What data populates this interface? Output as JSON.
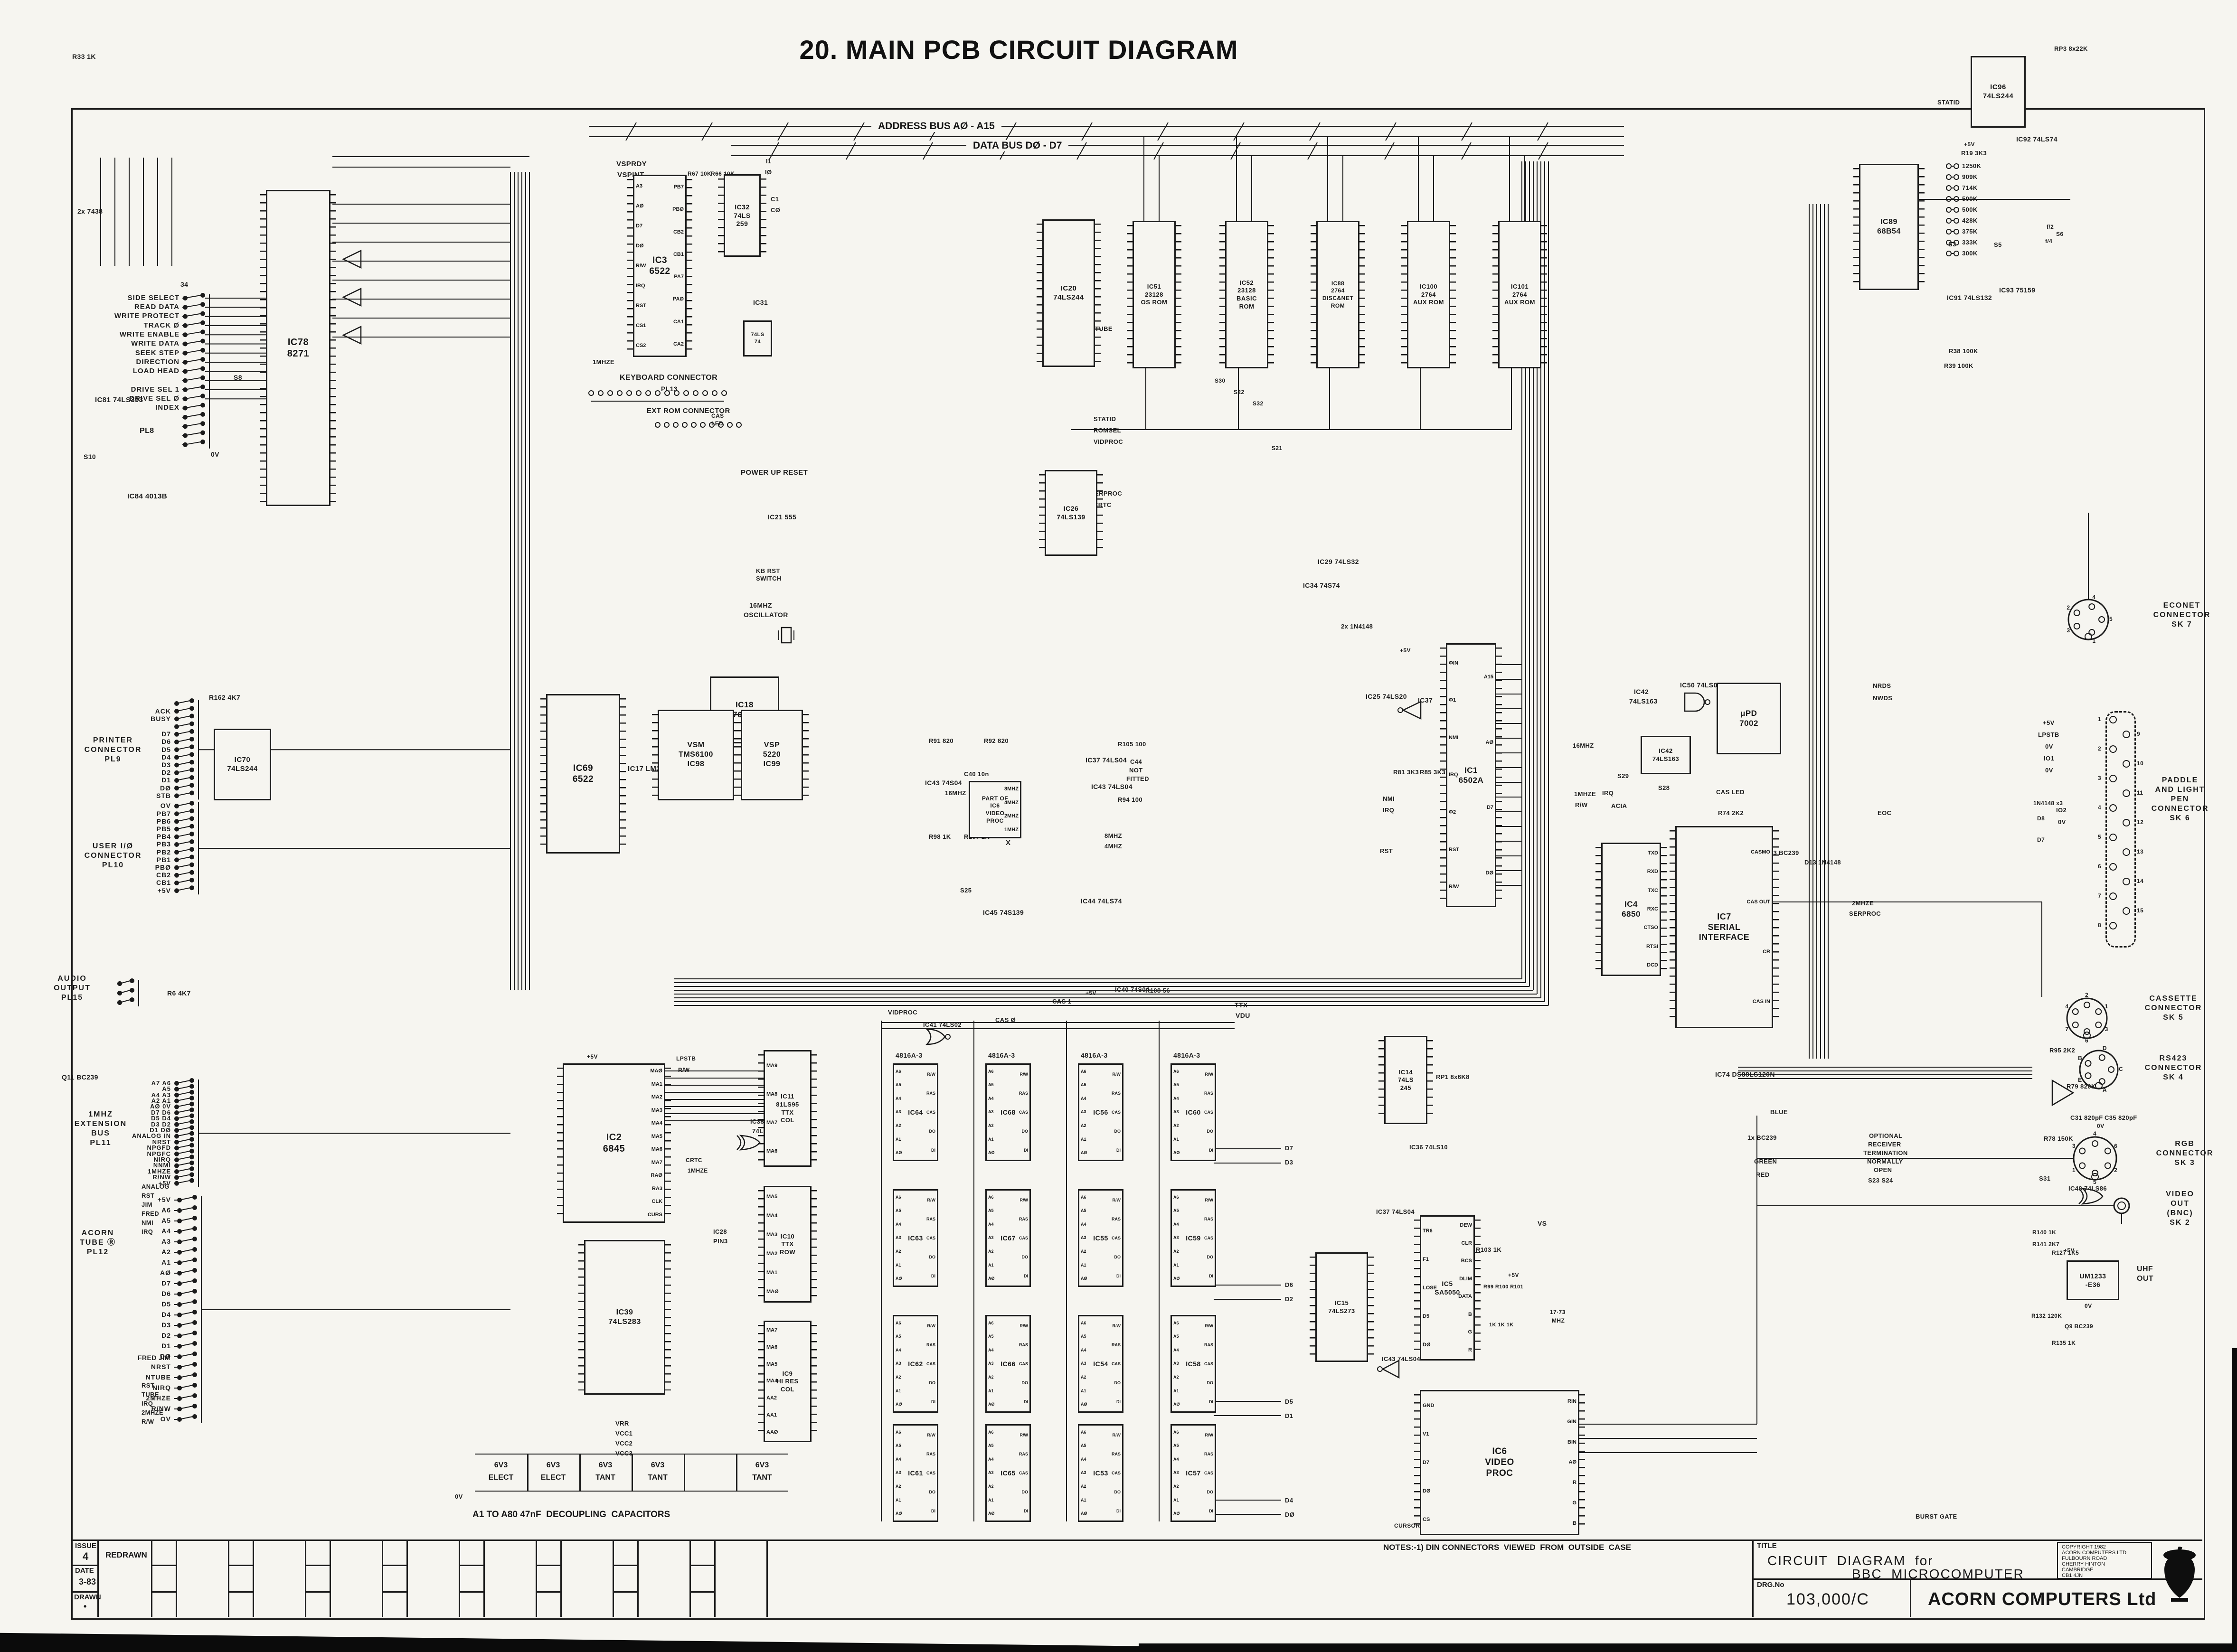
{
  "page": {
    "title": "20. MAIN PCB CIRCUIT DIAGRAM"
  },
  "buses": {
    "address": "ADDRESS BUS AØ - A15",
    "data": "DATA BUS DØ - D7"
  },
  "notes": {
    "note1": "NOTES:-1) DIN CONNECTORS  VIEWED  FROM  OUTSIDE  CASE",
    "decoupling": "A1 TO A80 47nF  DECOUPLING  CAPACITORS"
  },
  "revision": {
    "issue_label": "ISSUE",
    "issue_value": "4",
    "date_label": "DATE",
    "date_value": "3-83",
    "drawn_label": "DRAWN",
    "drawn_value": "•",
    "change_label": "REDRAWN"
  },
  "title_block": {
    "title_label": "TITLE",
    "title_line1": "CIRCUIT  DIAGRAM  for",
    "title_line2": "BBC  MICROCOMPUTER",
    "drg_label": "DRG.No",
    "drg_no": "103,000/C",
    "company": "ACORN COMPUTERS Ltd",
    "copyright_lines": [
      "COPYRIGHT 1982",
      "ACORN COMPUTERS LTD",
      "FULBOURN ROAD",
      "CHERRY HINTON",
      "CAMBRIDGE",
      "CB1 4JN"
    ]
  },
  "caps_table": [
    [
      "6V3",
      "ELECT"
    ],
    [
      "6V3",
      "ELECT"
    ],
    [
      "6V3",
      "TANT"
    ],
    [
      "6V3",
      "TANT"
    ],
    [
      "",
      ""
    ],
    [
      "6V3",
      "TANT"
    ]
  ],
  "ram": {
    "part": "4816A-3",
    "grid": [
      [
        "IC64",
        "IC68",
        "IC56",
        "IC60"
      ],
      [
        "IC63",
        "IC67",
        "IC55",
        "IC59"
      ],
      [
        "IC62",
        "IC66",
        "IC54",
        "IC58"
      ],
      [
        "IC61",
        "IC65",
        "IC53",
        "IC57"
      ]
    ],
    "left_pins": [
      "A6",
      "A5",
      "A4",
      "A3",
      "A2",
      "A1",
      "AØ"
    ],
    "right_pins": [
      "R/W",
      "RAS",
      "CAS",
      "DO",
      "DI"
    ]
  },
  "econet_links": [
    "1250K",
    "909K",
    "714K",
    "500K",
    "500K",
    "428K",
    "375K",
    "333K",
    "300K"
  ],
  "ics": [
    {
      "id": "IC78",
      "lines": [
        "IC78",
        "8271"
      ]
    },
    {
      "id": "IC3",
      "lines": [
        "IC3",
        "6522"
      ],
      "left": [
        "A3",
        "AØ",
        "D7",
        "DØ",
        "R/W",
        "IRQ",
        "RST",
        "CS1",
        "CS2"
      ],
      "right": [
        "PB7",
        "PBØ",
        "CB2",
        "CB1",
        "PA7",
        "PAØ",
        "CA1",
        "CA2"
      ]
    },
    {
      "id": "IC32",
      "lines": [
        "IC32",
        "74LS",
        "259"
      ]
    },
    {
      "id": "IC31",
      "lines": [
        "74LS",
        "74"
      ]
    },
    {
      "id": "IC20",
      "lines": [
        "IC20",
        "74LS244"
      ]
    },
    {
      "id": "IC51",
      "lines": [
        "IC51",
        "23128",
        "OS ROM"
      ]
    },
    {
      "id": "IC52",
      "lines": [
        "IC52",
        "23128",
        "BASIC",
        "ROM"
      ]
    },
    {
      "id": "IC88",
      "lines": [
        "IC88",
        "2764",
        "DISC&NET",
        "ROM"
      ]
    },
    {
      "id": "IC100",
      "lines": [
        "IC100",
        "2764",
        "AUX ROM"
      ]
    },
    {
      "id": "IC101",
      "lines": [
        "IC101",
        "2764",
        "AUX ROM"
      ]
    },
    {
      "id": "IC96",
      "lines": [
        "IC96",
        "74LS244"
      ]
    },
    {
      "id": "IC89",
      "lines": [
        "IC89",
        "68B54"
      ]
    },
    {
      "id": "IC26",
      "lines": [
        "IC26",
        "74LS139"
      ]
    },
    {
      "id": "IC18",
      "lines": [
        "IC18",
        "76489"
      ]
    },
    {
      "id": "IC98",
      "lines": [
        "VSM",
        "TMS6100",
        "IC98"
      ]
    },
    {
      "id": "IC99",
      "lines": [
        "VSP",
        "5220",
        "IC99"
      ]
    },
    {
      "id": "IC69",
      "lines": [
        "IC69",
        "6522"
      ]
    },
    {
      "id": "IC70",
      "lines": [
        "IC70",
        "74LS244"
      ]
    },
    {
      "id": "IC1",
      "lines": [
        "IC1",
        "6502A"
      ],
      "left": [
        "ΦIN",
        "Φ1",
        "NMI",
        "IRQ",
        "Φ2",
        "RST",
        "R/W"
      ],
      "right": [
        "A15",
        "AØ",
        "D7",
        "DØ"
      ]
    },
    {
      "id": "IC42",
      "lines": [
        "IC42",
        "74LS163"
      ]
    },
    {
      "id": "IC4",
      "lines": [
        "IC4",
        "6850"
      ],
      "right": [
        "TXD",
        "RXD",
        "TXC",
        "RXC",
        "CTSO",
        "RTSI",
        "DCD"
      ]
    },
    {
      "id": "IC7",
      "lines": [
        "IC7",
        "SERIAL",
        "INTERFACE"
      ],
      "right": [
        "CASMO",
        "CAS OUT",
        "CR",
        "CAS IN"
      ]
    },
    {
      "id": "IC73",
      "lines": [
        "µPD",
        "7002"
      ]
    },
    {
      "id": "IC2",
      "lines": [
        "IC2",
        "6845"
      ],
      "right": [
        "MAØ",
        "MA1",
        "MA2",
        "MA3",
        "MA4",
        "MA5",
        "MA6",
        "MA7",
        "RAØ",
        "RA3",
        "CLK",
        "CURS"
      ]
    },
    {
      "id": "IC11",
      "lines": [
        "IC11",
        "81LS95",
        "TTX",
        "COL"
      ],
      "left": [
        "MA9",
        "MA8",
        "MA7",
        "MA6"
      ]
    },
    {
      "id": "IC10",
      "lines": [
        "IC10",
        "TTX",
        "ROW"
      ],
      "left": [
        "MA5",
        "MA4",
        "MA3",
        "MA2",
        "MA1",
        "MAØ"
      ]
    },
    {
      "id": "IC9",
      "lines": [
        "IC9",
        "HI RES",
        "COL"
      ],
      "left": [
        "MA7",
        "MA6",
        "MA5",
        "MA4",
        "AA2",
        "AA1",
        "AAØ"
      ]
    },
    {
      "id": "IC39",
      "lines": [
        "IC39",
        "74LS283"
      ]
    },
    {
      "id": "IC14",
      "lines": [
        "IC14",
        "74LS",
        "245"
      ]
    },
    {
      "id": "IC15",
      "lines": [
        "IC15",
        "74LS273"
      ]
    },
    {
      "id": "IC5",
      "lines": [
        "IC5",
        "SA5050"
      ],
      "left": [
        "TR6",
        "F1",
        "LOSE",
        "D5",
        "DØ"
      ],
      "right": [
        "DEW",
        "CLR",
        "BCS",
        "DLIM",
        "DATA",
        "B",
        "G",
        "R"
      ]
    },
    {
      "id": "IC6",
      "lines": [
        "IC6",
        "VIDEO",
        "PROC"
      ],
      "left": [
        "GND",
        "V1",
        "D7",
        "DØ",
        "CS"
      ],
      "right": [
        "RIN",
        "GIN",
        "BIN",
        "AØ",
        "R",
        "G",
        "B"
      ]
    },
    {
      "id": "UM1233",
      "lines": [
        "UM1233",
        "-E36"
      ]
    },
    {
      "id": "IC6CLK",
      "lines": [
        "PART OF",
        "IC6",
        "VIDEO",
        "PROC"
      ],
      "right": [
        "8MHZ",
        "4MHZ",
        "2MHZ",
        "1MHZ"
      ]
    }
  ],
  "left_conns": [
    {
      "heading": [],
      "pins": [
        "SIDE SELECT",
        "READ DATA",
        "WRITE PROTECT",
        "TRACK Ø",
        "WRITE ENABLE",
        "WRITE DATA",
        "SEEK STEP",
        "DIRECTION",
        "LOAD HEAD",
        "",
        "DRIVE SEL 1",
        "DRIVE SEL Ø",
        "INDEX",
        "",
        "",
        "",
        ""
      ]
    },
    {
      "heading": [
        "PRINTER",
        "CONNECTOR",
        "PL9"
      ],
      "pins": [
        "",
        "ACK",
        "BUSY",
        "",
        "D7",
        "D6",
        "D5",
        "D4",
        "D3",
        "D2",
        "D1",
        "DØ",
        "STB"
      ]
    },
    {
      "heading": [
        "USER I/Ø",
        "CONNECTOR",
        "PL10"
      ],
      "pins": [
        "OV",
        "PB7",
        "PB6",
        "PB5",
        "PB4",
        "PB3",
        "PB2",
        "PB1",
        "PBØ",
        "CB2",
        "CB1",
        "+5V"
      ]
    },
    {
      "heading": [
        "1MHZ",
        "EXTENSION",
        "BUS",
        "PL11"
      ],
      "pins": [
        "A7 A6",
        "A5",
        "A4 A3",
        "A2 A1",
        "AØ 0V",
        "D7 D6",
        "D5 D4",
        "D3 D2",
        "D1 DØ",
        "ANALOG IN",
        "NRST",
        "NPGFD",
        "NPGFC",
        "NIRQ",
        "NNMI",
        "1MHZE",
        "R/NW",
        "+5V"
      ]
    },
    {
      "heading": [
        "ACORN",
        "TUBE Ⓡ",
        "PL12"
      ],
      "pins": [
        "+5V",
        "A6",
        "A5",
        "A4",
        "A3",
        "A2",
        "A1",
        "AØ",
        "D7",
        "D6",
        "D5",
        "D4",
        "D3",
        "D2",
        "D1",
        "DØ",
        "NRST",
        "NTUBE",
        "NIRQ",
        "2MHZE",
        "R/NW",
        "OV"
      ]
    },
    {
      "heading": [
        "AUDIO",
        "OUTPUT",
        "PL15"
      ],
      "pins": [
        "",
        "",
        ""
      ]
    }
  ],
  "right_conns": [
    {
      "lines": [
        "ECONET",
        "CONNECTOR",
        "SK 7"
      ],
      "pins": [
        "2",
        "4",
        "5",
        "1",
        "3"
      ]
    },
    {
      "lines": [
        "PADDLE",
        "AND LIGHT",
        "PEN",
        "CONNECTOR",
        "SK 6"
      ],
      "pins": [
        "1",
        "2",
        "3",
        "4",
        "5",
        "6",
        "7",
        "8"
      ],
      "pins2": [
        "9",
        "10",
        "11",
        "12",
        "13",
        "14",
        "15"
      ]
    },
    {
      "lines": [
        "CASSETTE",
        "CONNECTOR",
        "SK 5"
      ],
      "pins": [
        "4",
        "2",
        "1",
        "3",
        "6",
        "7"
      ]
    },
    {
      "lines": [
        "RS423",
        "CONNECTOR",
        "SK 4"
      ],
      "pins": [
        "B",
        "D",
        "C",
        "A",
        "E"
      ]
    },
    {
      "lines": [
        "RGB",
        "CONNECTOR",
        "SK 3"
      ],
      "pins": [
        "3",
        "4",
        "6",
        "2",
        "5",
        "1"
      ]
    },
    {
      "lines": [
        "VIDEO",
        "OUT",
        "(BNC)",
        "SK 2"
      ],
      "pins": []
    }
  ],
  "misc_labels": [
    "R33 1K",
    "2x 7438",
    "IC81 74LS393",
    "IC84 4013B",
    "S8",
    "S10",
    "PL8",
    "34",
    "0V",
    "R162 4K7",
    "R6 4K7",
    "IC17 LM324",
    "Q11 BC239",
    "FRED JIM",
    "1MHZE",
    "ANALOG",
    "RST",
    "JIM",
    "FRED",
    "NMI",
    "IRQ",
    "RST",
    "TUBE",
    "IRQ",
    "2MHZE",
    "R/W",
    "VSPRDY",
    "VSPINT",
    "R67 10K",
    "R66 10K",
    "I1",
    "IØ",
    "C1",
    "CØ",
    "IC31",
    "KEYBOARD CONNECTOR",
    "PL13",
    "EXT ROM CONNECTOR",
    "CAS",
    "LED",
    "POWER UP RESET",
    "IC21 555",
    "16MHZ",
    "OSCILLATOR",
    "KB RST",
    "SWITCH",
    "STATID",
    "ROMSEL",
    "VIDPROC",
    "SERPROC",
    "CRTC",
    "TUBE",
    "S30",
    "S22",
    "S32",
    "S21",
    "2x 1N4148",
    "IC29 74LS32",
    "IC34 74S74",
    "IC25 74LS20",
    "IC37",
    "R81 3K3",
    "R85 3K3",
    "NMI",
    "IRQ",
    "RST",
    "IC43 74S04",
    "R91 820",
    "R92 820",
    "C40 10n",
    "16MHZ",
    "R98 1K",
    "R107 1K",
    "X",
    "IC37 74LS04",
    "IC43 74LS04",
    "R105 100",
    "R94 100",
    "C44",
    "NOT",
    "FITTED",
    "8MHZ",
    "4MHZ",
    "S25",
    "IC45 74S139",
    "IC44 74LS74",
    "16MHZ",
    "1MHZE",
    "IRQ",
    "R/W",
    "ACIA",
    "S29",
    "S28",
    "IC50 74LS00",
    "IC42",
    "74LS163",
    "R74 2K2",
    "D9 1N4148",
    "NOT REQ",
    "R75 100K",
    "2x BC239",
    "C28 4µ7",
    "C30 10µF",
    "CAS LED",
    "Q3 BC239",
    "D13 1N4148",
    "NRDS",
    "NWDS",
    "EOC",
    "2MHZE",
    "SERPROC",
    "RP3 8x22K",
    "IC92 74LS74",
    "R19 3K3",
    "S3",
    "S5",
    "f/2",
    "S6",
    "f/4",
    "IC93 75159",
    "IC91 74LS132",
    "R38 100K",
    "R39 100K",
    "STATID",
    "IC74 DS88LS120N",
    "OPTIONAL",
    "RECEIVER",
    "TERMINATION",
    "NORMALLY",
    "OPEN",
    "S23 S24",
    "R95 2K2",
    "+5V",
    "LPSTB",
    "0V",
    "IO1",
    "0V",
    "IO2",
    "0V",
    "1N4148 x3",
    "D8",
    "D7",
    "R79 820K",
    "C31 820pF",
    "C35 820pF",
    "R78 150K",
    "S31",
    "IC48 74LS86",
    "R140 1K",
    "R141 2K7",
    "R127 1K5",
    "R132 120K",
    "Q9 BC239",
    "R135 1K",
    "UHF",
    "OUT",
    "0V",
    "+5V",
    "0V",
    "VS",
    "IC37 74LS04",
    "R103 1K",
    "17·73",
    "MHZ",
    "R99 R100 R101",
    "1K 1K 1K",
    "IC43 74LS04",
    "IC36 74LS10",
    "TTX",
    "VDU",
    "IC38",
    "74LS86",
    "IC28",
    "PIN3",
    "+5V",
    "LPSTB",
    "R/W",
    "CRTC",
    "1MHZE",
    "1x BC239",
    "BLUE",
    "GREEN",
    "RED",
    "HS",
    "CURSOR",
    "DISEN",
    "BURST GATE",
    "VIDPROC",
    "IC41 74LS02",
    "CAS Ø",
    "CAS 1",
    "IC40 74S04",
    "R108 56",
    "RP1 8x6K8",
    "+5V",
    "D7",
    "D3",
    "D6",
    "D2",
    "D5",
    "D1",
    "D4",
    "DØ",
    "VRR",
    "VCC1",
    "VCC2",
    "VCC3",
    "0V",
    "+5V",
    "+5V",
    "+5V",
    "+5V"
  ]
}
